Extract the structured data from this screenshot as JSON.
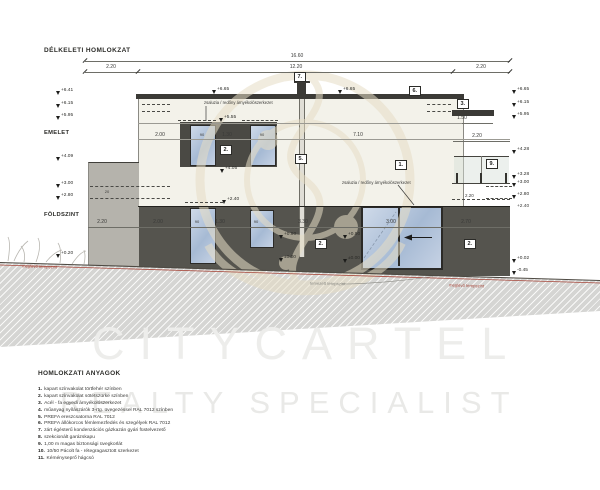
{
  "title": "DÉLKELETI HOMLOKZAT",
  "floor_labels": {
    "upper": "EMELET",
    "ground": "FÖLDSZINT"
  },
  "dims": {
    "total": "16.60",
    "mid": "12.20",
    "side_left": "2.20",
    "side_right": "2.20",
    "up_left": "2.00",
    "win_a": "90",
    "win_gap": "1.30",
    "win_b": "90",
    "up_right": "7.10",
    "terrace": "2.20",
    "bar_len": "1.50",
    "terrace_low": "2.20",
    "wall_thk": "20",
    "gf": [
      "2.20",
      "2.00",
      "90",
      "1.30",
      "90",
      "3.30",
      "3.00",
      "2.70"
    ]
  },
  "levels": {
    "left": [
      "+6.41",
      "+6.15",
      "+5.95",
      "+4.09",
      "+3.00",
      "+2.80",
      "+0.20"
    ],
    "right": [
      "+6.65",
      "+6.15",
      "+5.95",
      "+4.28",
      "+3.28",
      "+3.00",
      "+2.80",
      "+2.40",
      "+0.02",
      "-0.45"
    ],
    "roof_a": "+6.65",
    "roof_b": "+6.65",
    "lintel": "+5.55",
    "sill": "+4.05",
    "slab": "+2.40",
    "gf_a": "+0.90",
    "gf_b": "±0.00",
    "gf_c": "+0.90",
    "gf_d": "±0.00"
  },
  "callouts": {
    "c1": "1.",
    "c2": "2.",
    "c3": "3.",
    "c5": "5.",
    "c6": "6.",
    "c7": "7.",
    "c9": "9."
  },
  "notes": {
    "shading": "zsaluzia / redőny árnyékolószerkezet",
    "terrain_existing": "meglévő terepszint",
    "terrain_planned": "tervezett terepszint"
  },
  "materials": {
    "title": "HOMLOKZATI ANYAGOK",
    "items": [
      {
        "n": "1.",
        "t": "kapart színvakolat törtfehér színben"
      },
      {
        "n": "2.",
        "t": "kapart színvakolat sötétszürke színben"
      },
      {
        "n": "3.",
        "t": "Acél - fa egyedi árnyékolószerkezet"
      },
      {
        "n": "4.",
        "t": "műanyag nyílászárók 3-rtg. üvegezéssel RAL 7012 színben"
      },
      {
        "n": "5.",
        "t": "PREFA ereszcsatorna RAL 7012"
      },
      {
        "n": "6.",
        "t": "PREFA állókorcos fémlemezfedés és szegélyek RAL 7012"
      },
      {
        "n": "7.",
        "t": "zárt égésterű kondenzációs gázkazán gyári füstelvezető"
      },
      {
        "n": "8.",
        "t": "szekcionált garázskapu"
      },
      {
        "n": "9.",
        "t": "1,00 m magas biztonsági üvegkorlát"
      },
      {
        "n": "10.",
        "t": "10/50 Pácolt fa - rétegragasztott szerkezet"
      },
      {
        "n": "11.",
        "t": "Kéményseprő hágcsó"
      }
    ]
  },
  "watermark": {
    "line1": "CITYCARTEL",
    "line2": "REALTY SPECIALIST"
  },
  "colors": {
    "wall_light": "#f3f2ea",
    "wall_dark": "#55544e",
    "wall_grey": "#b5b3ac",
    "roof": "#3b3a36",
    "glass": "#b9c7db",
    "terrain_red": "#a84a3e"
  }
}
